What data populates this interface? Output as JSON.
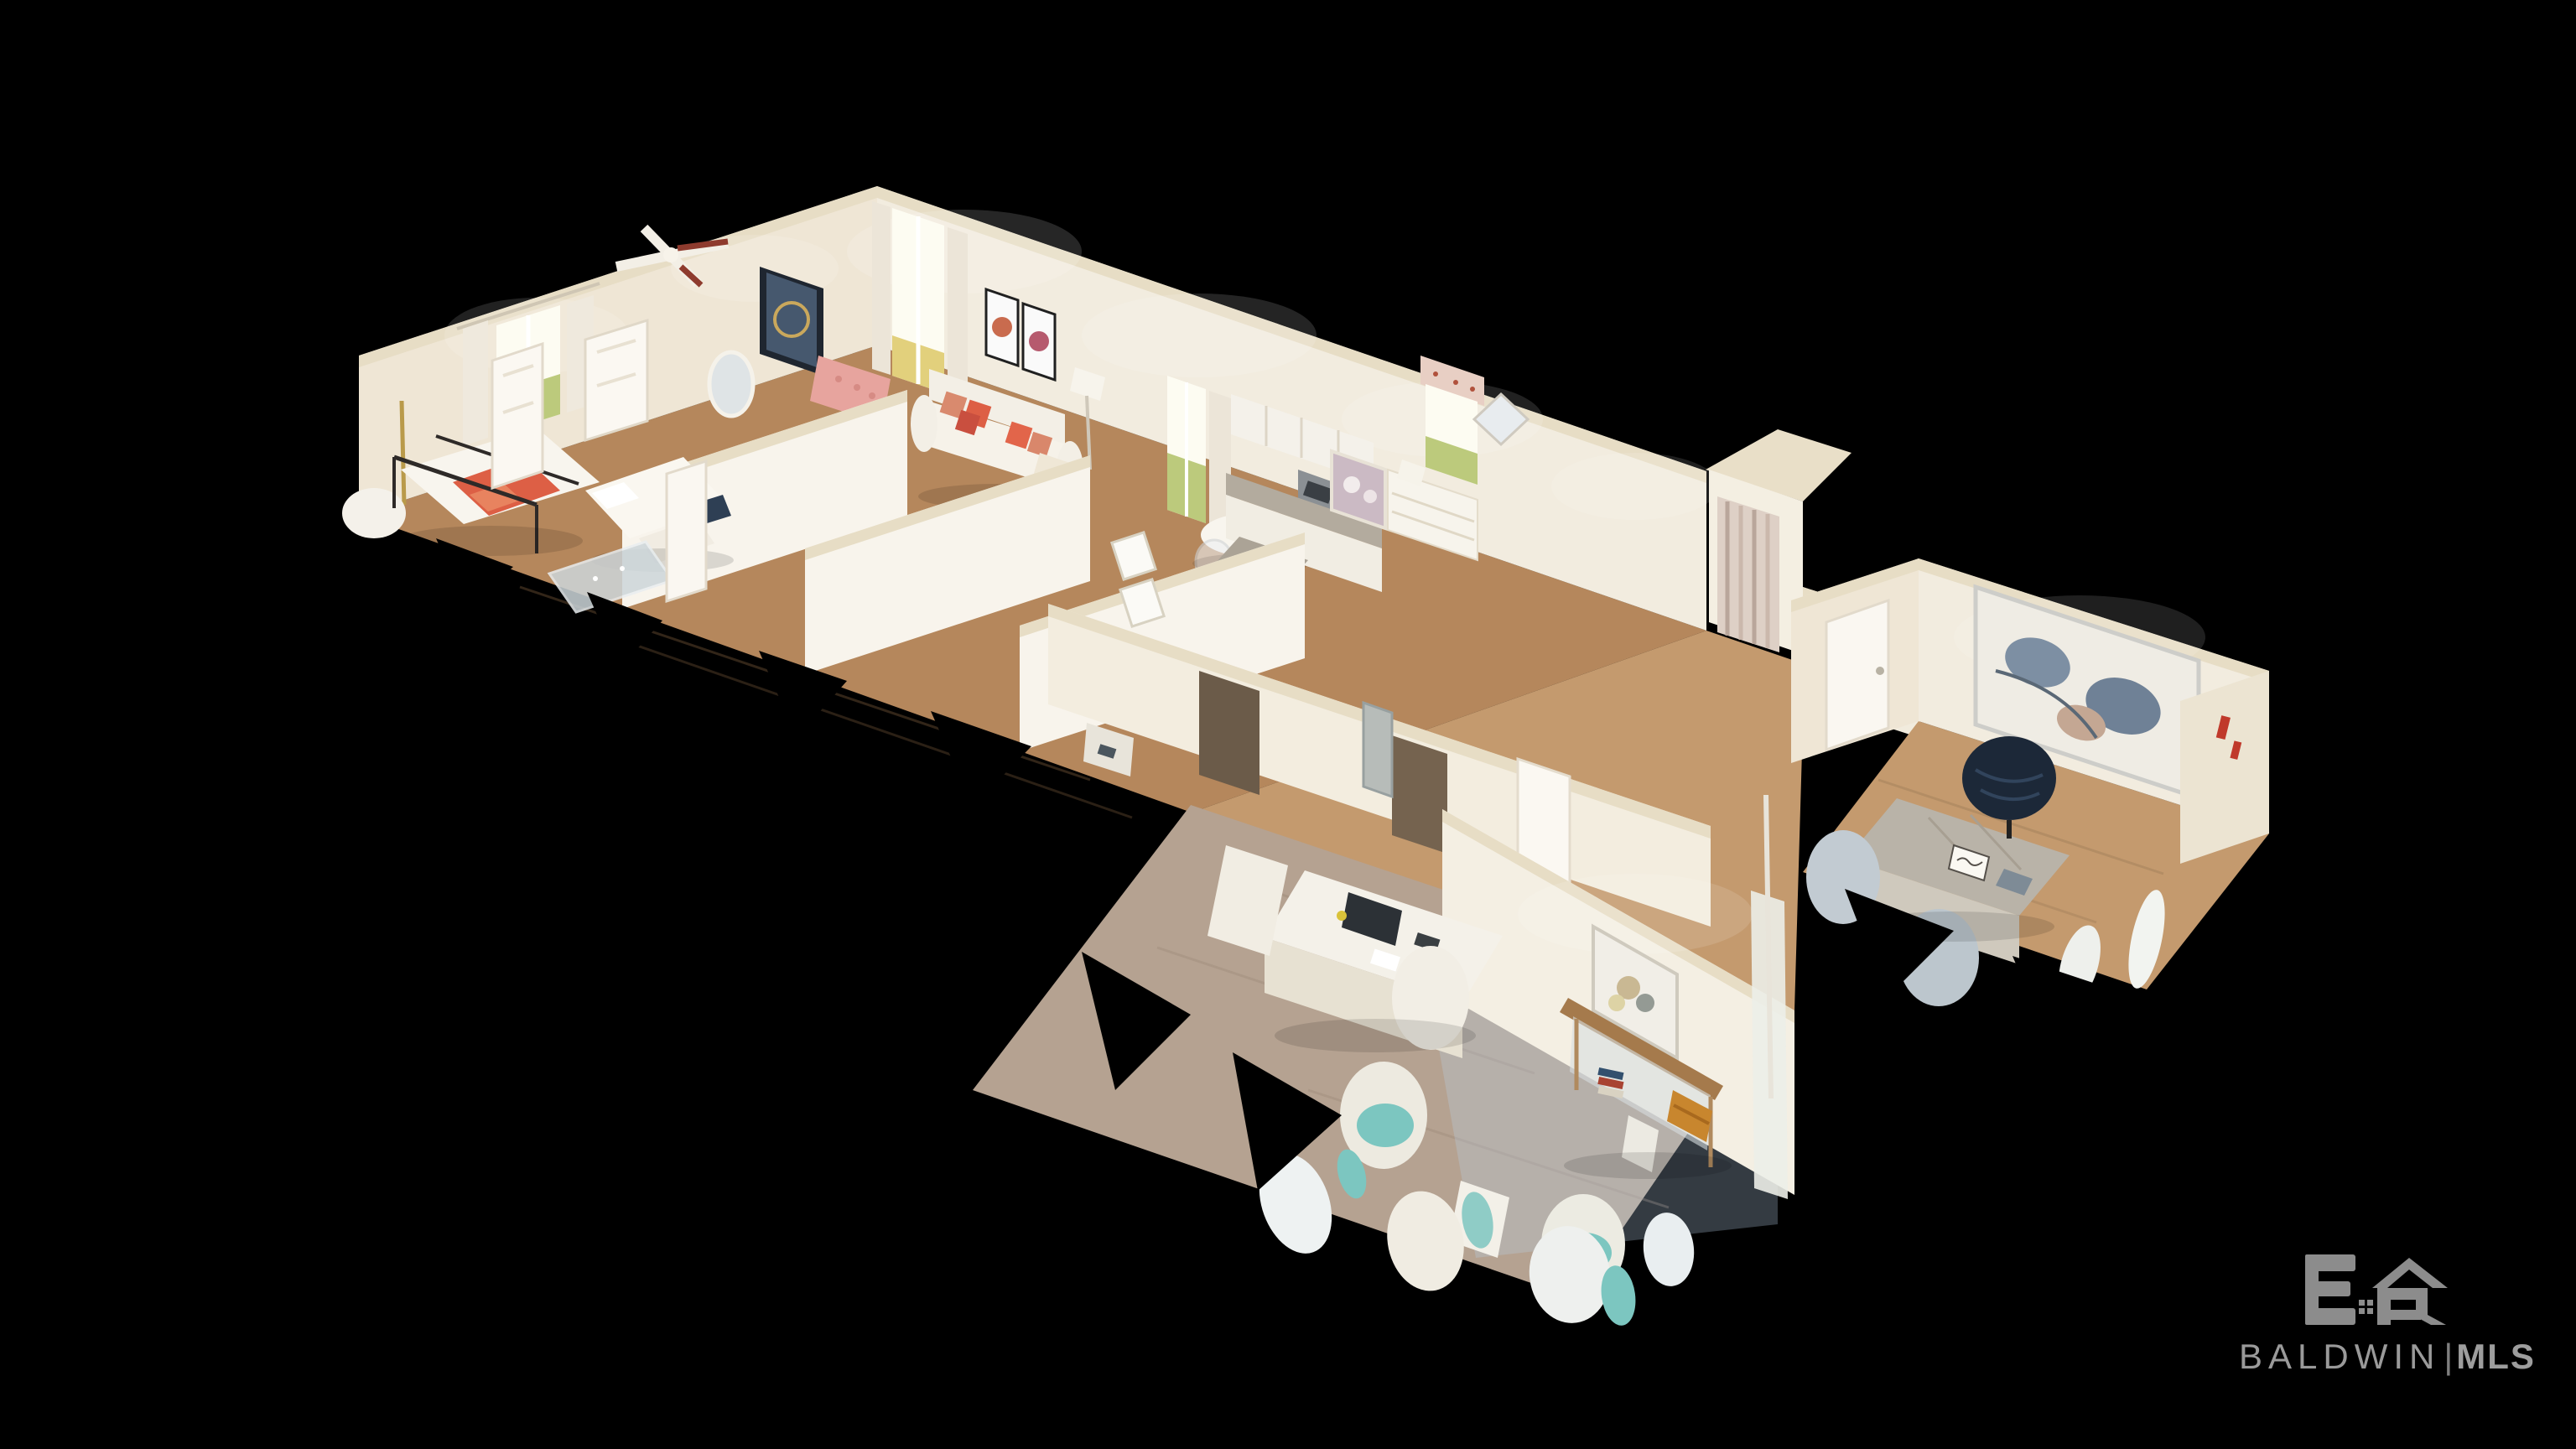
{
  "scene": {
    "type": "3d-dollhouse-floorplan",
    "description": "Cutaway 3D dollhouse scan of a single-story staged home viewed diagonally from above on a black background, with torn scan edges",
    "background": "#000000",
    "rooms": [
      {
        "id": "primary-bedroom",
        "features": [
          "iron-canopy-bed",
          "coral-throw",
          "sheer-curtained-window",
          "red-white-ceiling-fan",
          "gold-floor-lamp",
          "lounge-chair"
        ]
      },
      {
        "id": "bedroom-2",
        "features": [
          "white-bed",
          "foot-bench",
          "standing-doors",
          "glass-top-table"
        ]
      },
      {
        "id": "bedroom-3",
        "features": [
          "dresser",
          "floral-valance-window",
          "floral-art",
          "diamond-mirror",
          "table-lamp"
        ]
      },
      {
        "id": "living-room",
        "features": [
          "white-sofa",
          "coral-pillows",
          "pink-leopard-armchair",
          "navy-abstract-art",
          "butterfly-prints",
          "floor-lamp",
          "curtained-window"
        ]
      },
      {
        "id": "dining-area",
        "features": [
          "round-white-table",
          "acrylic-chairs",
          "curtained-window",
          "plant"
        ]
      },
      {
        "id": "kitchen",
        "features": [
          "white-cabinets",
          "granite-counters",
          "stainless-appliances",
          "island"
        ]
      },
      {
        "id": "bathroom",
        "features": [
          "striped-shower-curtain"
        ]
      },
      {
        "id": "hallway",
        "features": [
          "white-panel-doors",
          "electrical-panel",
          "bird-prints",
          "printer"
        ]
      },
      {
        "id": "reception-room",
        "features": [
          "reception-desk",
          "monitor",
          "teal-floral-chairs",
          "mirrored-console-table",
          "floral-bouquet-art",
          "amber-baskets",
          "books"
        ]
      },
      {
        "id": "office",
        "features": [
          "chevron-desk",
          "welcome-sign",
          "black-leather-executive-chair",
          "gray-guest-chairs",
          "large-abstract-art",
          "white-door"
        ]
      }
    ]
  },
  "watermark": {
    "initials": "BR",
    "logo_mark": "BR-house-monogram",
    "brand": "BALDWIN",
    "divider": "|",
    "org": "MLS"
  },
  "palette": {
    "background": "#000000",
    "wall": "#f2ecdf",
    "wall_warm": "#efe6d5",
    "wall_cut": "#e7ddc5",
    "partition": "#f8f4ec",
    "floor_wood": "#b5875c",
    "floor_wood_light": "#c49a6e",
    "floor_taupe": "#b5a291",
    "window_glow": "#fdfcf2",
    "landscape_green": "#bcca7c",
    "sofa_white": "#f6f2e9",
    "accent_coral": "#dd5f45",
    "accent_pink": "#e7a49e",
    "accent_teal": "#7cc6c0",
    "chair_black": "#1c2838",
    "desk_gray": "#b9b3a8",
    "console_wood": "#a57a4c",
    "basket_amber": "#c8862e",
    "granite": "#b3ab9e",
    "stainless": "#8b9094",
    "logo_gray": "#8c8c8c"
  }
}
